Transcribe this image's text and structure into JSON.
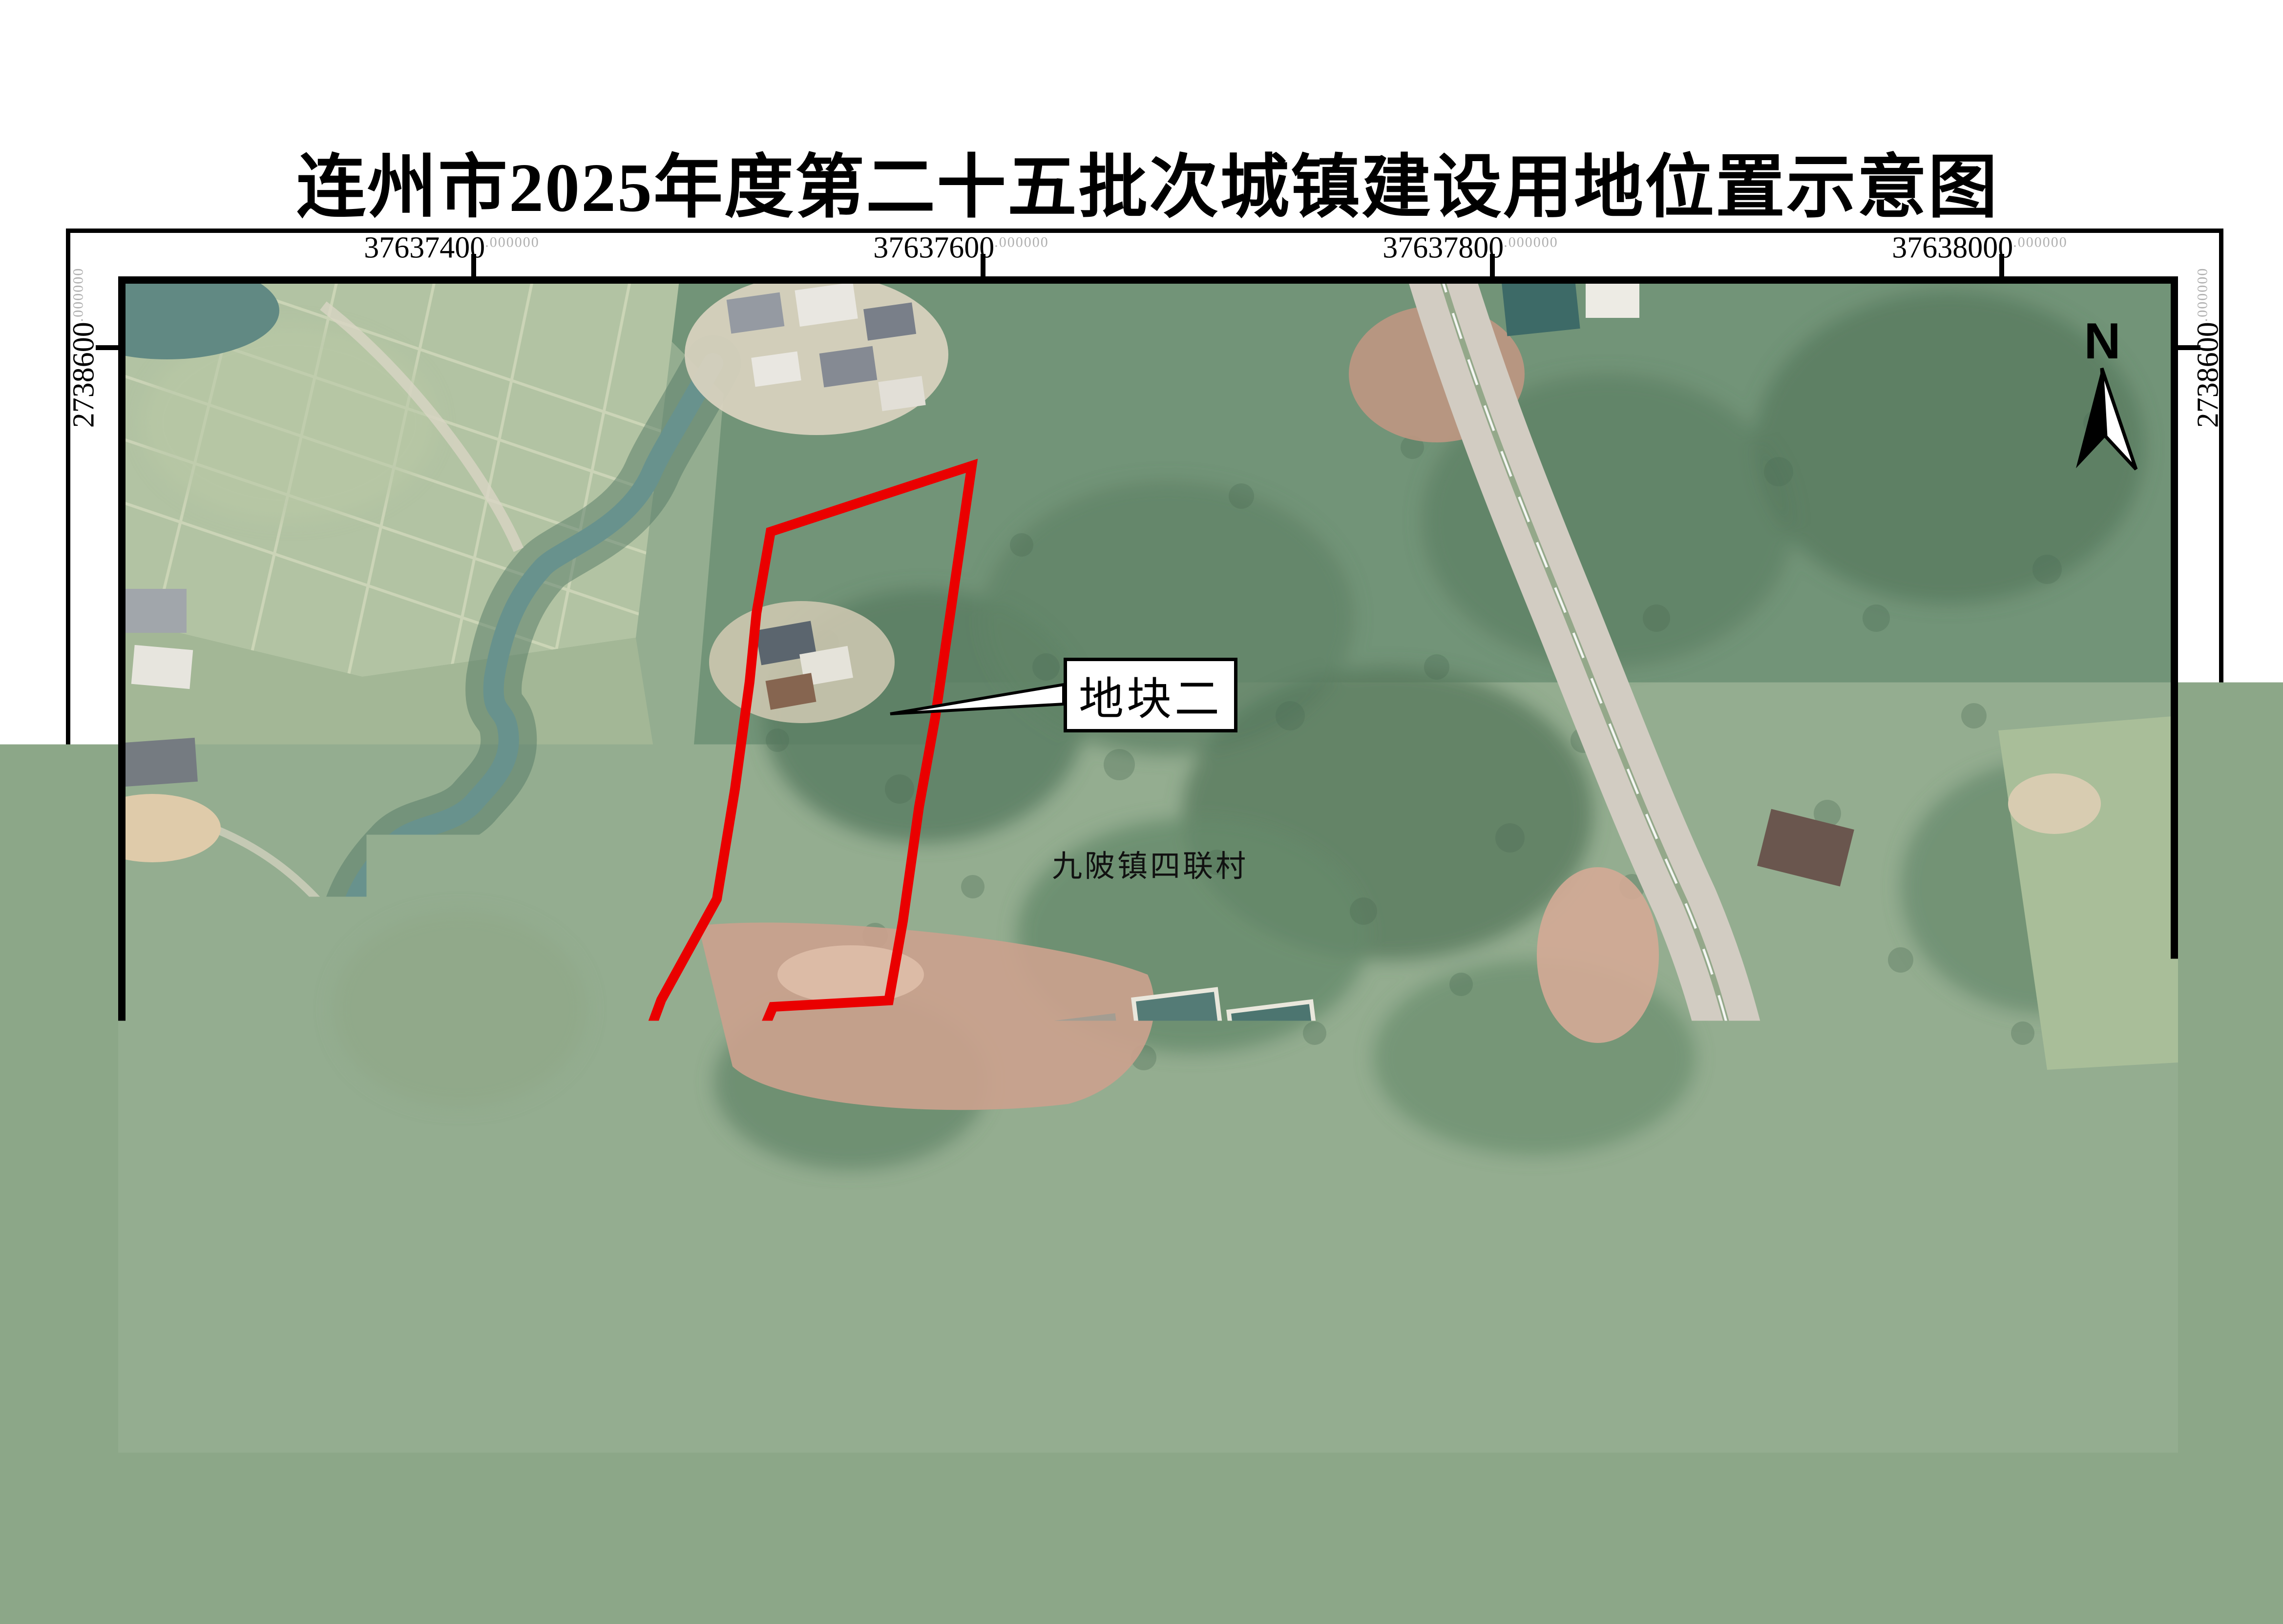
{
  "title": "连州市2025年度第二十五批次城镇建设用地位置示意图",
  "map": {
    "scale_text": "1:3,000",
    "north_label": "N",
    "village_label": "九陂镇四联村",
    "plot1_label": "地块一",
    "plot2_label": "地块二",
    "xticks": [
      {
        "num": "37637400",
        "suffix": ".000000"
      },
      {
        "num": "37637600",
        "suffix": ".000000"
      },
      {
        "num": "37637800",
        "suffix": ".000000"
      },
      {
        "num": "38000",
        "full": "37638000",
        "suffix": ".000000",
        "num_full": "37638000"
      }
    ],
    "xticks_note": "labels shown top and bottom",
    "yticks": [
      {
        "num": "2738600",
        "suffix": ".000000"
      },
      {
        "num": "2738400",
        "suffix": ".000000"
      },
      {
        "num": "2738200",
        "suffix": ".000000"
      }
    ]
  },
  "footer": {
    "line1": "2000国家大地坐标系",
    "line2": "1985国家高程基准"
  },
  "colors": {
    "boundary_red": "#ea0000",
    "frame_black": "#000000",
    "suffix_gray": "#b0b0b0"
  }
}
